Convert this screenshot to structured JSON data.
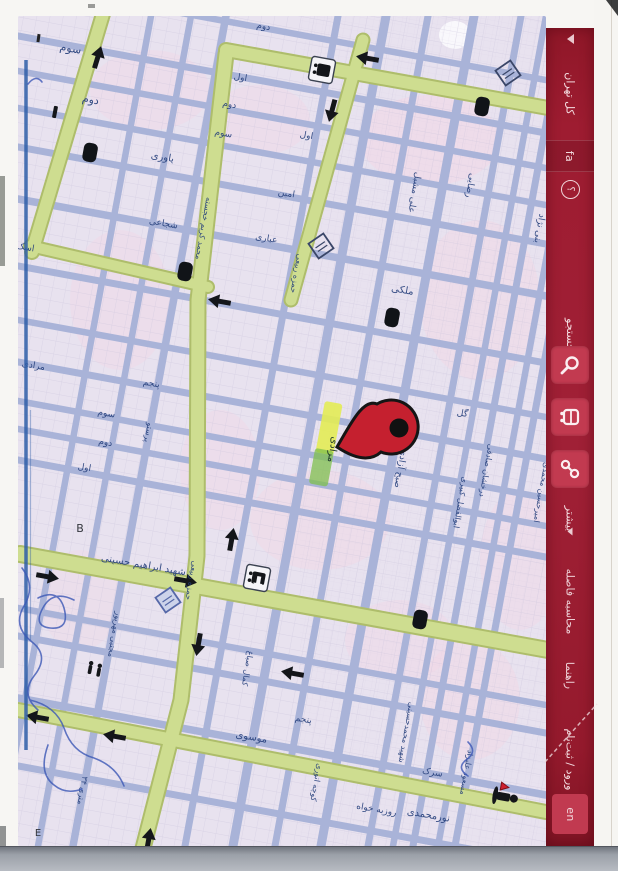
{
  "app": {
    "kind": "scanned printout of an online city map (rotated 90°)",
    "accent_red": "#9e1c31",
    "button_red": "#c23a50"
  },
  "sidebar": {
    "region_label": "کل تهران",
    "lang_fa": "fa",
    "help_glyph": "؟",
    "search_label": "جستجو",
    "more_label": "بیشتر",
    "calc_distance_label": "محاسبه فاصله",
    "guide_label": "راهنما",
    "login_label": "ورود / ثبت‌نام",
    "lang_en": "en",
    "icons": [
      "search-icon",
      "bus-icon",
      "route-icon",
      "help-icon",
      "dropdown-caret-icon"
    ]
  },
  "map": {
    "bg": "#e8e2ef",
    "street_color": "#a9b3d8",
    "major_road_fill": "#cedd90",
    "major_road_edge": "#aebd6b",
    "label_color": "#26407c",
    "pin_color": "#c5202f",
    "highlight_color": "#e3ec55",
    "pin_street_label": "مرادی",
    "labels": [
      {
        "t": "سوم",
        "x": 70,
        "y": 52,
        "r": 10,
        "s": 11
      },
      {
        "t": "دوم",
        "x": 90,
        "y": 103,
        "r": 10,
        "s": 11
      },
      {
        "t": "یاوری",
        "x": 162,
        "y": 160,
        "r": 10,
        "s": 10
      },
      {
        "t": "دوم",
        "x": 229,
        "y": 107,
        "r": 10,
        "s": 9
      },
      {
        "t": "سوم",
        "x": 223,
        "y": 136,
        "r": 10,
        "s": 9
      },
      {
        "t": "شجاعی",
        "x": 163,
        "y": 226,
        "r": 10,
        "s": 9
      },
      {
        "t": "اول",
        "x": 240,
        "y": 80,
        "r": 10,
        "s": 9
      },
      {
        "t": "دوم",
        "x": 263,
        "y": 29,
        "r": 10,
        "s": 9
      },
      {
        "t": "اول",
        "x": 306,
        "y": 138,
        "r": 10,
        "s": 9
      },
      {
        "t": "امین",
        "x": 286,
        "y": 196,
        "r": 10,
        "s": 9
      },
      {
        "t": "عباری",
        "x": 266,
        "y": 241,
        "r": 10,
        "s": 9
      },
      {
        "t": "محمد کریم خجسته",
        "x": 201,
        "y": 228,
        "r": 100,
        "s": 8
      },
      {
        "t": "حمزه ربیعی",
        "x": 294,
        "y": 273,
        "r": 100,
        "s": 8
      },
      {
        "t": "علی مشبل",
        "x": 412,
        "y": 192,
        "r": 100,
        "s": 9
      },
      {
        "t": "رضایی",
        "x": 468,
        "y": 185,
        "r": 100,
        "s": 9
      },
      {
        "t": "بنی نژاد",
        "x": 537,
        "y": 228,
        "r": 100,
        "s": 9
      },
      {
        "t": "ملکی",
        "x": 402,
        "y": 293,
        "r": 10,
        "s": 10
      },
      {
        "t": "گل",
        "x": 462,
        "y": 416,
        "r": 10,
        "s": 9
      },
      {
        "t": "صبح آزادی",
        "x": 398,
        "y": 468,
        "r": 100,
        "s": 9
      },
      {
        "t": "درخشان صادقی",
        "x": 484,
        "y": 470,
        "r": 100,
        "s": 8
      },
      {
        "t": "ابوالفضل کبیری",
        "x": 458,
        "y": 502,
        "r": 100,
        "s": 8
      },
      {
        "t": "امیرحسین محمدی",
        "x": 539,
        "y": 492,
        "r": 100,
        "s": 8
      },
      {
        "t": "مرادی",
        "x": 33,
        "y": 368,
        "r": 10,
        "s": 9
      },
      {
        "t": "پنجم",
        "x": 151,
        "y": 386,
        "r": 10,
        "s": 9
      },
      {
        "t": "سوم",
        "x": 106,
        "y": 416,
        "r": 10,
        "s": 9
      },
      {
        "t": "دوم",
        "x": 105,
        "y": 445,
        "r": 10,
        "s": 9
      },
      {
        "t": "اول",
        "x": 84,
        "y": 470,
        "r": 10,
        "s": 9
      },
      {
        "t": "پرستو",
        "x": 146,
        "y": 432,
        "r": 100,
        "s": 8
      },
      {
        "t": "شهید ابراهیم حسینی",
        "x": 143,
        "y": 568,
        "r": 10,
        "s": 10
      },
      {
        "t": "حمزه ربیعی",
        "x": 189,
        "y": 580,
        "r": 100,
        "s": 8
      },
      {
        "t": "کمال صباغ",
        "x": 245,
        "y": 668,
        "r": 100,
        "s": 8
      },
      {
        "t": "موسوی",
        "x": 251,
        "y": 740,
        "r": 10,
        "s": 10
      },
      {
        "t": "مجتبی مهرپور",
        "x": 112,
        "y": 634,
        "r": 100,
        "s": 8
      },
      {
        "t": "پنجم",
        "x": 303,
        "y": 722,
        "r": 10,
        "s": 9
      },
      {
        "t": "کوچه انوری",
        "x": 314,
        "y": 782,
        "r": 100,
        "s": 8
      },
      {
        "t": "روزبه خواه",
        "x": 376,
        "y": 812,
        "r": 10,
        "s": 9
      },
      {
        "t": "شهید محمدحسینی",
        "x": 404,
        "y": 732,
        "r": 100,
        "s": 8
      },
      {
        "t": "مسعود علیزاد",
        "x": 464,
        "y": 772,
        "r": 100,
        "s": 8
      },
      {
        "t": "سرک",
        "x": 432,
        "y": 775,
        "r": 10,
        "s": 9
      },
      {
        "t": "نورمحمدی",
        "x": 428,
        "y": 818,
        "r": 10,
        "s": 10
      },
      {
        "t": "۳۴ متری",
        "x": 80,
        "y": 790,
        "r": 100,
        "s": 8
      },
      {
        "t": "اسک",
        "x": 25,
        "y": 250,
        "r": 10,
        "s": 9
      },
      {
        "t": "B",
        "x": 80,
        "y": 532,
        "r": 0,
        "s": 11,
        "c": "#24282e"
      },
      {
        "t": "E",
        "x": 38,
        "y": 836,
        "r": 0,
        "s": 10,
        "c": "#24282e"
      }
    ],
    "arrows": [
      {
        "x": 100,
        "y": 50,
        "a": -73
      },
      {
        "x": 360,
        "y": 57,
        "a": 190
      },
      {
        "x": 330,
        "y": 118,
        "a": 105
      },
      {
        "x": 212,
        "y": 300,
        "a": 190
      },
      {
        "x": 55,
        "y": 578,
        "a": 10
      },
      {
        "x": 193,
        "y": 582,
        "a": 10
      },
      {
        "x": 197,
        "y": 652,
        "a": 100
      },
      {
        "x": 285,
        "y": 672,
        "a": 190
      },
      {
        "x": 30,
        "y": 716,
        "a": 190
      },
      {
        "x": 107,
        "y": 735,
        "a": 190
      },
      {
        "x": 150,
        "y": 832,
        "a": -80
      },
      {
        "x": 233,
        "y": 532,
        "a": -80
      }
    ],
    "icons": [
      {
        "k": "bus-box",
        "x": 322,
        "y": 70
      },
      {
        "k": "blob",
        "x": 482,
        "y": 107
      },
      {
        "k": "blob",
        "x": 185,
        "y": 272
      },
      {
        "k": "blob",
        "x": 392,
        "y": 318
      },
      {
        "k": "blob",
        "x": 420,
        "y": 620
      },
      {
        "k": "blob",
        "x": 90,
        "y": 153
      },
      {
        "k": "tick",
        "x": 55,
        "y": 112
      },
      {
        "k": "station-box",
        "x": 257,
        "y": 578
      },
      {
        "k": "diamond",
        "x": 508,
        "y": 73
      },
      {
        "k": "diamond",
        "x": 321,
        "y": 246
      },
      {
        "k": "diamond-blue",
        "x": 168,
        "y": 600
      },
      {
        "k": "pedestrians",
        "x": 95,
        "y": 670
      },
      {
        "k": "person-warning",
        "x": 505,
        "y": 797
      }
    ]
  }
}
